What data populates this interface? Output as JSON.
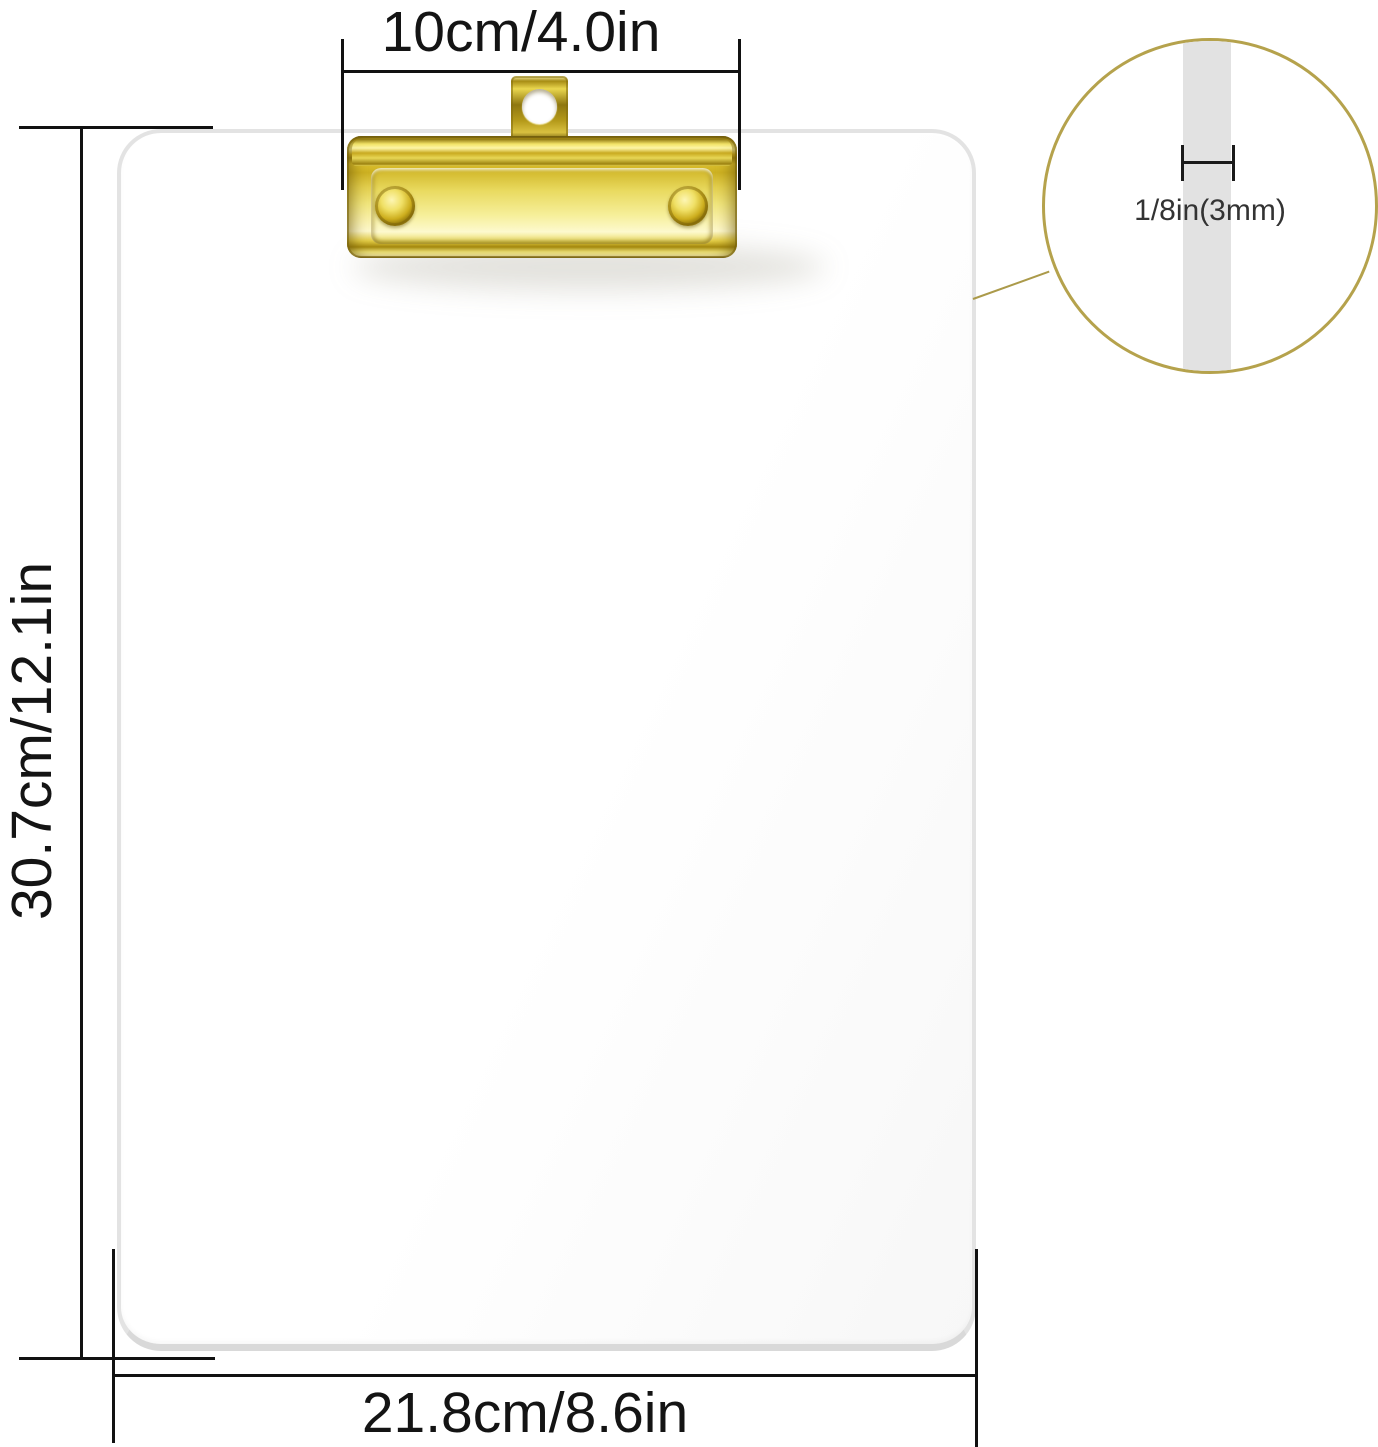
{
  "annotations": {
    "top_width_label": "10cm/4.0in",
    "left_height_label": "30.7cm/12.1in",
    "bottom_width_label": "21.8cm/8.6in",
    "thickness_label": "1/8in(3mm)"
  },
  "colors": {
    "gold_clip_bright": "#f5e76e",
    "gold_clip_highlight": "#fdf8cc",
    "gold_clip_dark": "#8a7410",
    "detail_circle_stroke": "#b5a24c",
    "leader_line": "#ab9a4a",
    "dimension_line": "#111111",
    "dimension_text": "#141414",
    "board_edge": "#e3e3e3",
    "thickness_stripe": "#e2e2e2",
    "background": "#ffffff"
  }
}
